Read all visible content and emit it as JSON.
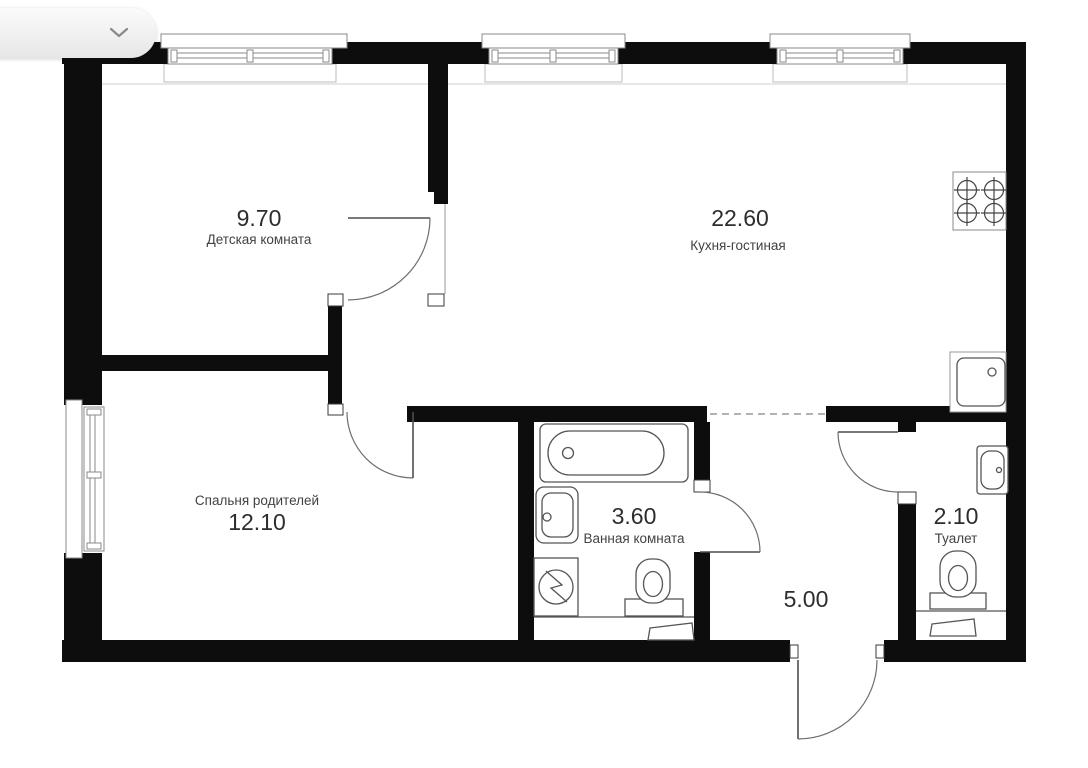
{
  "plan": {
    "rooms": [
      {
        "name": "children-room",
        "area": "9.70",
        "label": "Детская комната"
      },
      {
        "name": "kitchen-living",
        "area": "22.60",
        "label": "Кухня-гостиная"
      },
      {
        "name": "parents-bedroom",
        "area": "12.10",
        "label": "Спальня родителей"
      },
      {
        "name": "bathroom",
        "area": "3.60",
        "label": "Ванная комната"
      },
      {
        "name": "toilet",
        "area": "2.10",
        "label": "Туалет"
      },
      {
        "name": "hallway",
        "area": "5.00",
        "label": ""
      }
    ],
    "colors": {
      "wall": "#0d0d0d",
      "fixture_line": "#555555",
      "thin_line": "#9a9a9a",
      "text": "#2d2d2d",
      "background": "#ffffff"
    }
  },
  "controls": {
    "selector": {
      "icon": "chevron-down"
    }
  }
}
